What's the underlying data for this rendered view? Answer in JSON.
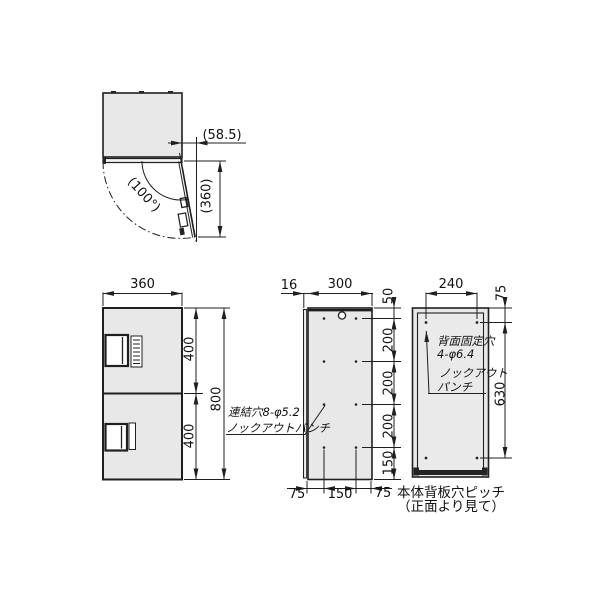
{
  "colors": {
    "line": "#1f1f1f",
    "panel_fill": "#e8e8e8",
    "background": "#ffffff"
  },
  "top_view": {
    "open_angle": "(100°)",
    "protrusion": "(58.5)",
    "door_length": "(360)"
  },
  "front_view": {
    "width": "360",
    "upper_door_height": "400",
    "lower_door_height": "400",
    "total_height": "800"
  },
  "side_view": {
    "front_offset": "16",
    "depth": "300",
    "pitch_top": "50",
    "pitch_1": "200",
    "pitch_2": "200",
    "pitch_3": "200",
    "pitch_bottom": "150",
    "bottom_left": "75",
    "bottom_center": "150",
    "bottom_right": "75",
    "note_line1": "連結穴8-φ5.2",
    "note_line2": "ノックアウトパンチ"
  },
  "back_view": {
    "hole_pitch_width": "240",
    "hole_offset_top": "75",
    "hole_pitch_height": "630",
    "note_line1": "背面固定穴",
    "note_line2": "4-φ6.4",
    "note_line3": "ノックアウト",
    "note_line4": "パンチ",
    "caption_line1": "本体背板穴ピッチ",
    "caption_line2": "（正面より見て）"
  }
}
